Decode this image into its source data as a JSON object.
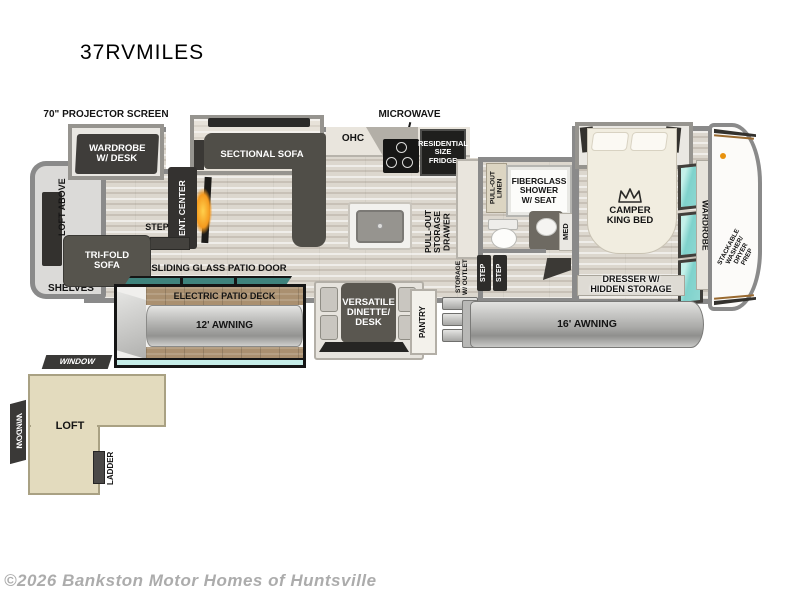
{
  "model": "37RVMILES",
  "watermark": "©2026 Bankston Motor Homes of Huntsville",
  "exterior": {
    "projector": "70\" PROJECTOR SCREEN",
    "microwave": "MICROWAVE",
    "sliding_door": "SLIDING GLASS PATIO DOOR",
    "patio_deck": "ELECTRIC PATIO DECK",
    "awning_12": "12' AWNING",
    "awning_16": "16' AWNING",
    "window_top": "WINDOW",
    "window_side": "WINDOW",
    "loft": "LOFT",
    "ladder": "LADDER"
  },
  "living": {
    "wardrobe_desk": "WARDROBE\nW/ DESK",
    "loft_above": "LOFT ABOVE",
    "sectional_sofa": "SECTIONAL SOFA",
    "ent_center": "ENT. CENTER",
    "tri_fold_sofa": "TRI-FOLD\nSOFA",
    "shelves": "SHELVES",
    "step": "STEP"
  },
  "kitchen": {
    "ohc": "OHC",
    "fridge": "RESIDENTIAL\nSIZE\nFRIDGE",
    "pull_out_storage": "PULL-OUT\nSTORAGE\nDRAWER",
    "dinette": "VERSATILE\nDINETTE/\nDESK",
    "pantry": "PANTRY"
  },
  "bath": {
    "pull_out_linen": "PULL-OUT\nLINEN",
    "shower": "FIBERGLASS\nSHOWER\nW/ SEAT",
    "med": "MED",
    "storage_outlet": "STORAGE\nW/ OUTLET",
    "step_1": "STEP",
    "step_2": "STEP"
  },
  "bedroom": {
    "bed": "CAMPER\nKING BED",
    "wardrobe": "WARDROBE",
    "dresser": "DRESSER W/\nHIDDEN STORAGE",
    "washer_prep": "STACKABLE\nWASHER/\nDRYER\nPREP"
  },
  "colors": {
    "wall": "#8a8a8a",
    "dark_furniture": "#504e48",
    "teal_window": "#7fd2cc",
    "teal_door": "#3f837d",
    "deck_wood": "#aa9070",
    "loft_fill": "#e3dbbe",
    "fireplace_orange": "#f59a1e",
    "watermark_gray": "#acacac"
  }
}
